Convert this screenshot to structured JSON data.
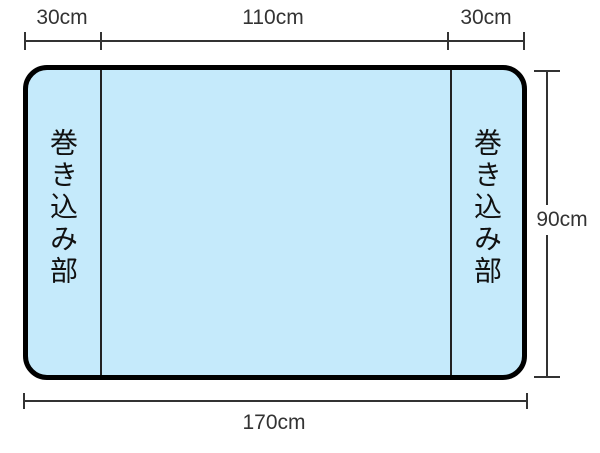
{
  "dimensions": {
    "top_left": "30cm",
    "top_center": "110cm",
    "top_right": "30cm",
    "right": "90cm",
    "bottom": "170cm"
  },
  "sections": {
    "left_label": "巻き込み部",
    "right_label": "巻き込み部"
  },
  "colors": {
    "sheet_fill": "#c5eafb",
    "sheet_border": "#000000",
    "dimension_line": "#333333",
    "label_text": "#333333"
  }
}
